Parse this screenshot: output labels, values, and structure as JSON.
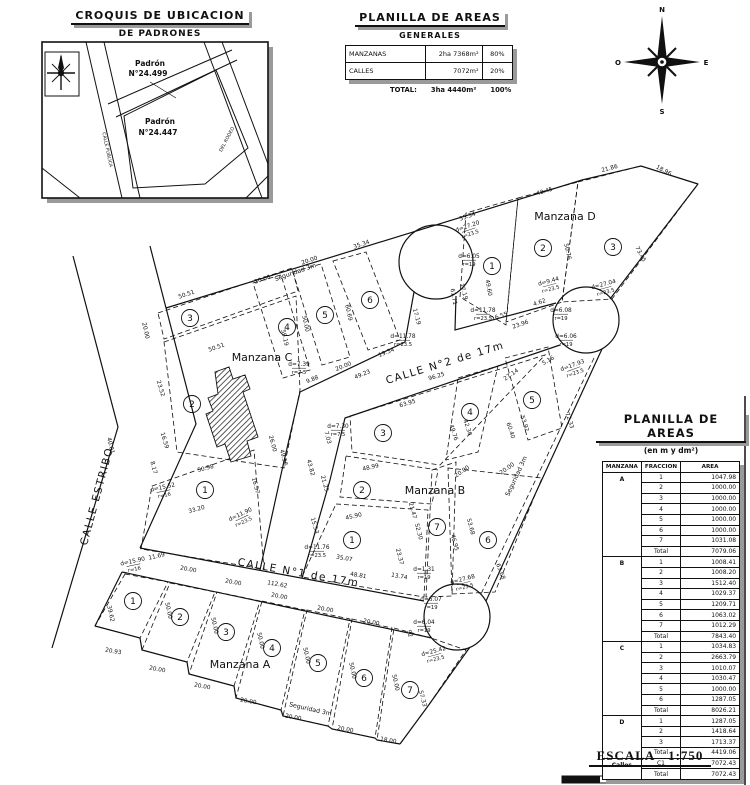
{
  "croquis": {
    "title": "CROQUIS DE UBICACION",
    "subtitle": "DE PADRONES",
    "padron_1": {
      "line1": "Padrón",
      "line2": "N°24.499"
    },
    "padron_2": {
      "line1": "Padrón",
      "line2": "N°24.447"
    },
    "street_1": "CALLE PUBLICA",
    "street_2": "DEL RODEO"
  },
  "generales": {
    "title": "PLANILLA DE AREAS",
    "subtitle": "GENERALES",
    "rows": [
      {
        "label": "MANZANAS",
        "value": "2ha 7368m²",
        "pct": "80%"
      },
      {
        "label": "CALLES",
        "value": "7072m²",
        "pct": "20%"
      }
    ],
    "total_label": "TOTAL:",
    "total_value": "3ha 4440m²",
    "total_pct": "100%"
  },
  "areas_table": {
    "title": "PLANILLA DE AREAS",
    "subtitle": "(en m y dm²)",
    "headers": [
      "MANZANA",
      "FRACCION",
      "AREA"
    ],
    "groups": [
      {
        "manzana": "A",
        "rows": [
          [
            "1",
            "1047.98"
          ],
          [
            "2",
            "1000.00"
          ],
          [
            "3",
            "1000.00"
          ],
          [
            "4",
            "1000.00"
          ],
          [
            "5",
            "1000.00"
          ],
          [
            "6",
            "1000.00"
          ],
          [
            "7",
            "1031.08"
          ],
          [
            "Total",
            "7079.06"
          ]
        ]
      },
      {
        "manzana": "B",
        "rows": [
          [
            "1",
            "1008.41"
          ],
          [
            "2",
            "1008.20"
          ],
          [
            "3",
            "1512.40"
          ],
          [
            "4",
            "1029.37"
          ],
          [
            "5",
            "1209.71"
          ],
          [
            "6",
            "1063.02"
          ],
          [
            "7",
            "1012.29"
          ],
          [
            "Total",
            "7843.40"
          ]
        ]
      },
      {
        "manzana": "C",
        "rows": [
          [
            "1",
            "1034.83"
          ],
          [
            "2",
            "2663.79"
          ],
          [
            "3",
            "1010.07"
          ],
          [
            "4",
            "1030.47"
          ],
          [
            "5",
            "1000.00"
          ],
          [
            "6",
            "1287.05"
          ],
          [
            "Total",
            "8026.21"
          ]
        ]
      },
      {
        "manzana": "D",
        "rows": [
          [
            "1",
            "1287.05"
          ],
          [
            "2",
            "1418.64"
          ],
          [
            "3",
            "1713.37"
          ],
          [
            "Total",
            "4419.06"
          ]
        ]
      },
      {
        "manzana": "Calles",
        "rows": [
          [
            "C1",
            "7072.43"
          ],
          [
            "Total",
            "7072.43"
          ]
        ]
      }
    ]
  },
  "compass": {
    "n": "N",
    "s": "S",
    "e": "E",
    "o": "O"
  },
  "scale": {
    "label": "ESCALA",
    "ratio": "1:750"
  },
  "map": {
    "streets": [
      {
        "t": "CALLE ESTRIBO",
        "x": 100,
        "y": 497,
        "r": -75
      },
      {
        "t": "CALLE N°1  de  17m",
        "x": 298,
        "y": 576,
        "r": 10
      },
      {
        "t": "CALLE N°2  de  17m",
        "x": 446,
        "y": 366,
        "r": -17
      }
    ],
    "manzanas": [
      {
        "t": "Manzana A",
        "x": 240,
        "y": 665
      },
      {
        "t": "Manzana B",
        "x": 435,
        "y": 491
      },
      {
        "t": "Manzana C",
        "x": 262,
        "y": 358
      },
      {
        "t": "Manzana D",
        "x": 565,
        "y": 217
      }
    ],
    "seguridad": [
      {
        "t": "Seguridad 3m",
        "x": 296,
        "y": 274,
        "r": -19
      },
      {
        "t": "Seguridad 3m",
        "x": 518,
        "y": 477,
        "r": -65
      },
      {
        "t": "Seguridad 3m",
        "x": 310,
        "y": 711,
        "r": 13
      }
    ],
    "lots": [
      {
        "m": "C",
        "n": "1",
        "x": 205,
        "y": 490
      },
      {
        "m": "C",
        "n": "2",
        "x": 192,
        "y": 404
      },
      {
        "m": "C",
        "n": "3",
        "x": 190,
        "y": 318
      },
      {
        "m": "C",
        "n": "4",
        "x": 287,
        "y": 327
      },
      {
        "m": "C",
        "n": "5",
        "x": 325,
        "y": 315
      },
      {
        "m": "C",
        "n": "6",
        "x": 370,
        "y": 300
      },
      {
        "m": "D",
        "n": "1",
        "x": 492,
        "y": 266
      },
      {
        "m": "D",
        "n": "2",
        "x": 543,
        "y": 248
      },
      {
        "m": "D",
        "n": "3",
        "x": 613,
        "y": 247
      },
      {
        "m": "B",
        "n": "1",
        "x": 352,
        "y": 540
      },
      {
        "m": "B",
        "n": "2",
        "x": 362,
        "y": 490
      },
      {
        "m": "B",
        "n": "3",
        "x": 383,
        "y": 433
      },
      {
        "m": "B",
        "n": "4",
        "x": 470,
        "y": 412
      },
      {
        "m": "B",
        "n": "5",
        "x": 532,
        "y": 400
      },
      {
        "m": "B",
        "n": "6",
        "x": 488,
        "y": 540
      },
      {
        "m": "B",
        "n": "7",
        "x": 437,
        "y": 527
      },
      {
        "m": "A",
        "n": "1",
        "x": 133,
        "y": 601
      },
      {
        "m": "A",
        "n": "2",
        "x": 180,
        "y": 617
      },
      {
        "m": "A",
        "n": "3",
        "x": 226,
        "y": 632
      },
      {
        "m": "A",
        "n": "4",
        "x": 272,
        "y": 648
      },
      {
        "m": "A",
        "n": "5",
        "x": 318,
        "y": 663
      },
      {
        "m": "A",
        "n": "6",
        "x": 364,
        "y": 678
      },
      {
        "m": "A",
        "n": "7",
        "x": 410,
        "y": 690
      }
    ],
    "dims": [
      [
        "50.51",
        187,
        296,
        -19
      ],
      [
        "20.00",
        144,
        331,
        77
      ],
      [
        "50.51",
        217,
        349,
        -19
      ],
      [
        "23.52",
        159,
        389,
        73
      ],
      [
        "16.59",
        163,
        441,
        73
      ],
      [
        "20.00",
        263,
        281,
        -19
      ],
      [
        "20.00",
        310,
        262,
        -19
      ],
      [
        "35.34",
        362,
        246,
        -19
      ],
      [
        "59.19",
        283,
        338,
        78
      ],
      [
        "50.00",
        304,
        324,
        78
      ],
      [
        "60.69",
        347,
        313,
        78
      ],
      [
        "49.23",
        363,
        376,
        -22
      ],
      [
        "20.00",
        344,
        368,
        -22
      ],
      [
        "19.34",
        387,
        354,
        -22
      ],
      [
        "9.88",
        313,
        381,
        -22
      ],
      [
        "d=7.39",
        299,
        366,
        0,
        "r=7.5"
      ],
      [
        "d=7.30",
        338,
        428,
        0,
        "r=7.5"
      ],
      [
        "26.00",
        271,
        444,
        75
      ],
      [
        "49.56",
        282,
        458,
        75
      ],
      [
        "8.17",
        152,
        468,
        75
      ],
      [
        "50.98",
        206,
        470,
        -15
      ],
      [
        "16.57",
        254,
        486,
        75
      ],
      [
        "40.01",
        109,
        446,
        77
      ],
      [
        "d=15.52",
        163,
        489,
        -12,
        "r=16"
      ],
      [
        "33.20",
        197,
        511,
        -15
      ],
      [
        "d=11.90",
        241,
        516,
        -25,
        "r=23.5"
      ],
      [
        "11.69",
        157,
        558,
        -12
      ],
      [
        "d=15.90",
        133,
        563,
        -12,
        "r=16"
      ],
      [
        "112.62",
        277,
        586,
        10
      ],
      [
        "35.07",
        344,
        560,
        10
      ],
      [
        "48.81",
        358,
        577,
        10
      ],
      [
        "13.74",
        399,
        578,
        10
      ],
      [
        "39.62",
        109,
        614,
        77
      ],
      [
        "20.93",
        113,
        653,
        10
      ],
      [
        "20.00",
        157,
        671,
        10
      ],
      [
        "20.00",
        202,
        688,
        10
      ],
      [
        "20.00",
        248,
        703,
        10
      ],
      [
        "20.00",
        293,
        719,
        10
      ],
      [
        "20.00",
        345,
        731,
        10
      ],
      [
        "18.00",
        388,
        742,
        10
      ],
      [
        "20.00",
        188,
        571,
        10
      ],
      [
        "20.00",
        233,
        584,
        10
      ],
      [
        "20.00",
        279,
        598,
        10
      ],
      [
        "20.00",
        325,
        611,
        10
      ],
      [
        "20.00",
        371,
        624,
        10
      ],
      [
        "50.00",
        167,
        611,
        77
      ],
      [
        "50.00",
        213,
        626,
        77
      ],
      [
        "50.00",
        259,
        641,
        77
      ],
      [
        "50.00",
        305,
        656,
        77
      ],
      [
        "50.00",
        351,
        671,
        77
      ],
      [
        "50.00",
        394,
        683,
        77
      ],
      [
        "57.33",
        421,
        699,
        75
      ],
      [
        "92",
        408,
        634,
        75
      ],
      [
        "96.25",
        437,
        378,
        -17
      ],
      [
        "63.95",
        408,
        405,
        -17
      ],
      [
        "48.99",
        371,
        469,
        -12
      ],
      [
        "45.90",
        354,
        518,
        -12
      ],
      [
        "21.25",
        323,
        484,
        75
      ],
      [
        "43.82",
        309,
        468,
        75
      ],
      [
        "15.53",
        313,
        526,
        75
      ],
      [
        "d=11.76",
        317,
        549,
        0,
        "r=23.5"
      ],
      [
        "7.03",
        326,
        438,
        75
      ],
      [
        "21.47",
        411,
        511,
        75
      ],
      [
        "52.30",
        417,
        532,
        75
      ],
      [
        "23.37",
        398,
        557,
        75
      ],
      [
        "46.95",
        453,
        543,
        75
      ],
      [
        "53.68",
        469,
        527,
        75
      ],
      [
        "63.68",
        499,
        572,
        70
      ],
      [
        "d=1.31",
        424,
        571,
        0,
        "r=19"
      ],
      [
        "d=27.68",
        463,
        581,
        -15,
        "r=23.5"
      ],
      [
        "d=6.07",
        431,
        601,
        0,
        "r=19"
      ],
      [
        "d=6.04",
        424,
        624,
        0,
        "r=19"
      ],
      [
        "d=25.42",
        434,
        653,
        -15,
        "r=23.5"
      ],
      [
        "27.14",
        512,
        376,
        -35
      ],
      [
        "5.16",
        549,
        362,
        -30
      ],
      [
        "d=17.93",
        573,
        367,
        -20,
        "r=23.5"
      ],
      [
        "72.33",
        568,
        421,
        72
      ],
      [
        "60.40",
        509,
        431,
        72
      ],
      [
        "53.92",
        523,
        424,
        72
      ],
      [
        "20.00",
        463,
        473,
        -35
      ],
      [
        "20.00",
        508,
        470,
        -35
      ],
      [
        "49.76",
        452,
        433,
        72
      ],
      [
        "42.30",
        466,
        428,
        72
      ],
      [
        "35.34",
        468,
        218,
        -19
      ],
      [
        "40.45",
        545,
        193,
        -17
      ],
      [
        "21.86",
        610,
        170,
        -15
      ],
      [
        "18.96",
        663,
        172,
        28
      ],
      [
        "73.45",
        639,
        255,
        62
      ],
      [
        "50.76",
        566,
        252,
        77
      ],
      [
        "49.60",
        487,
        288,
        80
      ],
      [
        "61.71",
        452,
        297,
        80
      ],
      [
        "d=27.20",
        468,
        228,
        -19,
        "r=23.5"
      ],
      [
        "d=6.05",
        469,
        258,
        0,
        "r=19"
      ],
      [
        "d=11.78",
        483,
        312,
        0,
        "r=23.5"
      ],
      [
        "d=11.78",
        403,
        338,
        0,
        "r=23.5"
      ],
      [
        "16.55",
        500,
        318,
        -19
      ],
      [
        "23.96",
        521,
        326,
        -19
      ],
      [
        "4.62",
        540,
        304,
        -19
      ],
      [
        "d=6.08",
        561,
        312,
        0,
        "r=19"
      ],
      [
        "d=6.06",
        566,
        338,
        0,
        "r=19"
      ],
      [
        "d=9.44",
        549,
        283,
        -15,
        "r=23.5"
      ],
      [
        "d=27.04",
        604,
        286,
        -15,
        "r=23.5"
      ],
      [
        "17.19",
        415,
        317,
        75
      ],
      [
        "17.19",
        462,
        292,
        75
      ]
    ]
  }
}
